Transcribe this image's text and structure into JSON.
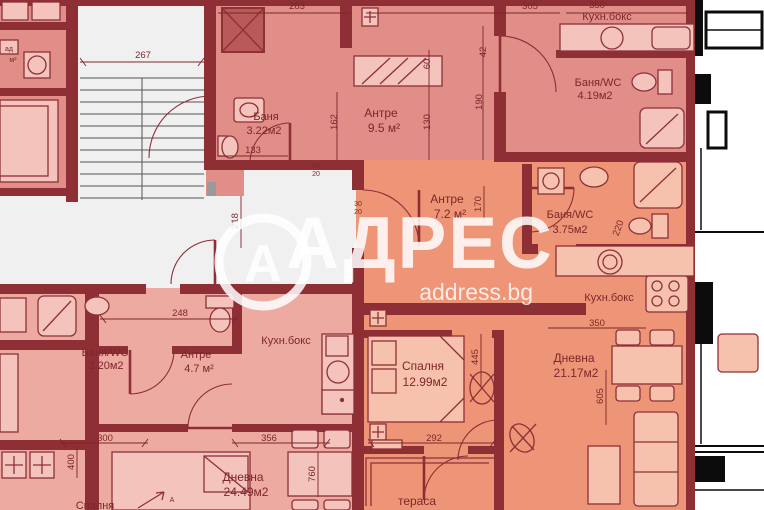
{
  "watermark": {
    "brand": "АДРЕС",
    "domain": "address.bg",
    "logo_letter": "А"
  },
  "rooms": {
    "antre_top": {
      "name": "Антре",
      "area": "9.5 м²"
    },
    "banya_top": {
      "name": "Баня",
      "area": "3.22м2"
    },
    "kitchen_top": {
      "name": "Кухн.бокс"
    },
    "banya_wc_top": {
      "name": "Баня/WC",
      "area": "4.19м2"
    },
    "antre_right": {
      "name": "Антре",
      "area": "7.2 м²"
    },
    "banya_wc_right": {
      "name": "Баня/WC",
      "area": "3.75м2"
    },
    "kitchen_right": {
      "name": "Кухн.бокс"
    },
    "living_right": {
      "name": "Дневна",
      "area": "21.17м2"
    },
    "bedroom_right": {
      "name": "Спалня",
      "area": "12.99м2"
    },
    "terrace": {
      "name": "тераса"
    },
    "banya_wc_left": {
      "name": "Баня/WC",
      "area": "3.20м2"
    },
    "antre_left": {
      "name": "Антре",
      "area": "4.7 м²"
    },
    "kitchen_left": {
      "name": "Кухн.бокс"
    },
    "living_left": {
      "name": "Дневна",
      "area": "24.49м2"
    },
    "bedroom_left": {
      "name": "Спалня"
    },
    "edge_fragment": {
      "line1": "ад",
      "line2": "м²"
    }
  },
  "entrance_marker": "А",
  "dimensions": {
    "stairs": "267",
    "top_a": "283",
    "top_b": "305",
    "top_c": "350",
    "bath_top": "133",
    "hall_v1": "162",
    "hall_v2": "60",
    "hall_v3": "130",
    "hall_v4": "42",
    "hall_v5": "190",
    "corridor": "218",
    "entry_left": "248",
    "antre_right_v": "170",
    "bath_right": "220",
    "kitchen_right_w": "350",
    "bl_a": "300",
    "bl_b": "400",
    "bl_c": "356",
    "bl_d": "760",
    "bed_w": "292",
    "bed_v": "445",
    "living_v": "605",
    "small_a1": "40",
    "small_a2": "20",
    "small_b1": "30",
    "small_b2": "20"
  },
  "colors": {
    "walls": "#8e2f35",
    "apartment_pink": "#e18d88",
    "apartment_orange": "#ee9577",
    "apartment_rose": "#ecaaa1",
    "fixture_pink": "#f3c3bc",
    "fixture_orange": "#f6c2ad",
    "corridor_white": "#f1f0f1",
    "text": "#7e262c",
    "watermark": "#ffffff",
    "black": "#0c0c0c"
  }
}
